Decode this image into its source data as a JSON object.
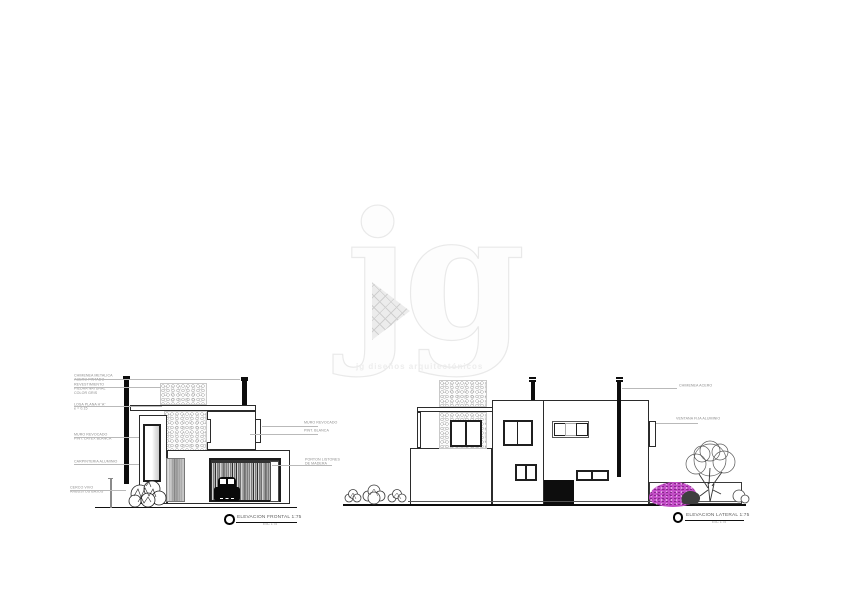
{
  "watermark": {
    "logo": "jg",
    "tagline": "jg diseños arquitectónicos"
  },
  "colors": {
    "line": "#2b2b2b",
    "leader": "#b9b9b9",
    "accent_bush": "#c44ec8",
    "watermark": "#ececec"
  },
  "elev1": {
    "title": "ELEVACION FRONTAL 1:75",
    "scale_note": "ESC 1:75",
    "ann_left": [
      "CHIMENEA METALICA\nACERO PINTADO",
      "REVESTIMIENTO\nPIEDRA NATURAL\nCOLOR GRIS",
      "LOSA PLANA H°A°\ne = 0.15",
      "MURO REVOCADO\nPINT. LATEX BLANCA",
      "CARPINTERIA ALUMINIO",
      "CERCO VIVO\nARBUSTOS BAJOS"
    ],
    "ann_right": [
      "MURO REVOCADO",
      "PINT. BLANCA",
      "PORTON LISTONES\nDE MADERA"
    ]
  },
  "elev2": {
    "title": "ELEVACION LATERAL 1:75",
    "scale_note": "ESC 1:75",
    "ann_right": [
      "CHIMENEA ACERO",
      "VENTANA FIJA ALUMINIO"
    ]
  }
}
